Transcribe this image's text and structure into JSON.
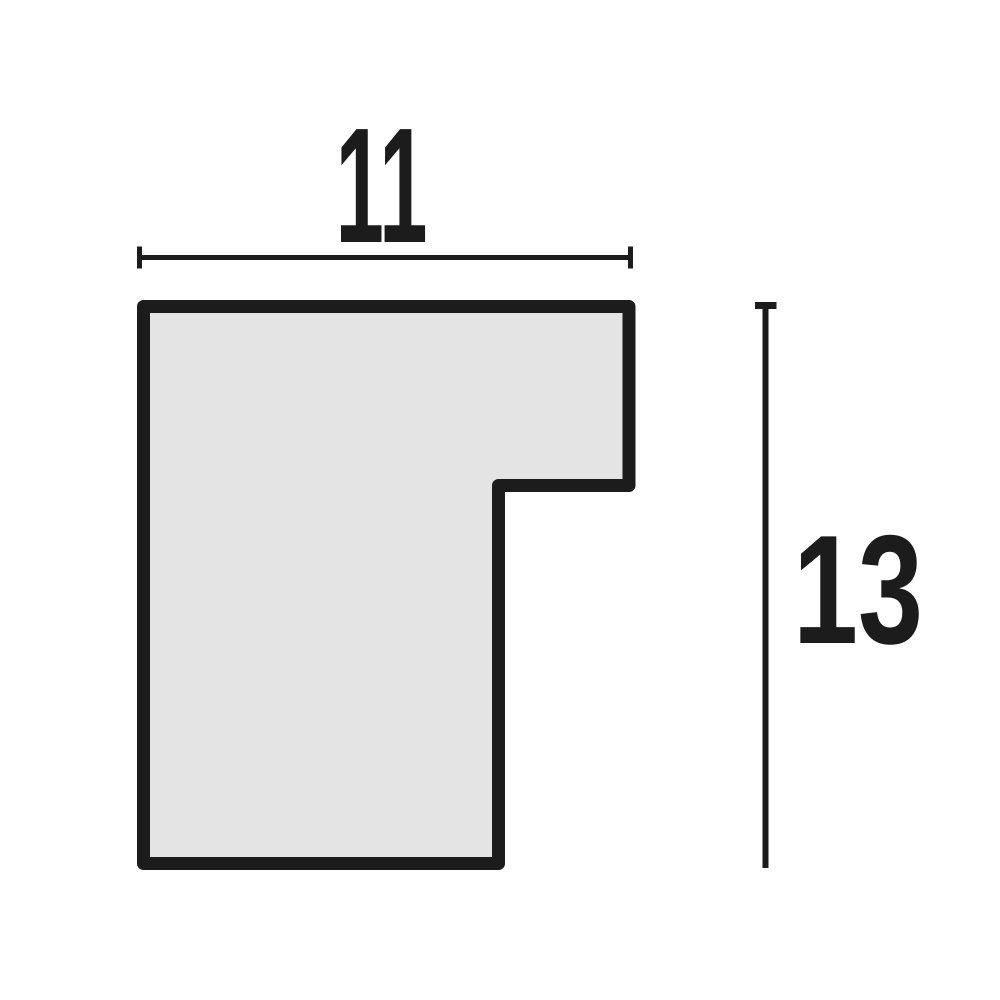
{
  "figure": {
    "width_dimension": {
      "label": "11",
      "value": 11
    },
    "height_dimension": {
      "label": "13",
      "value": 13
    },
    "colors": {
      "background": "#ffffff",
      "shape_fill": "#e4e4e4",
      "outline": "#1c1c1c",
      "dimension_lines": "#1c1c1c",
      "text": "#1c1c1c"
    }
  }
}
